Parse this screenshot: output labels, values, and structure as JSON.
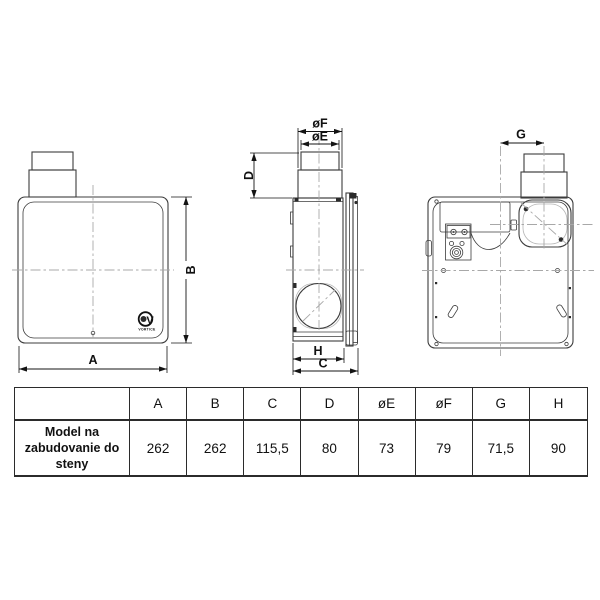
{
  "drawing": {
    "dim_labels": {
      "A": "A",
      "B": "B",
      "C": "C",
      "D": "D",
      "oE": "øE",
      "oF": "øF",
      "G": "G",
      "H": "H"
    },
    "logo": {
      "initial": "V",
      "brand": "VORTICE"
    }
  },
  "table": {
    "row_label": "Model na zabudovanie do steny",
    "headers": [
      "A",
      "B",
      "C",
      "D",
      "øE",
      "øF",
      "G",
      "H"
    ],
    "values": [
      "262",
      "262",
      "115,5",
      "80",
      "73",
      "79",
      "71,5",
      "90"
    ]
  },
  "colors": {
    "line": "#3c3c3c",
    "dim": "#141414",
    "centerline": "#a8a8a8",
    "background": "#ffffff",
    "table_border": "#2b2b2b"
  }
}
